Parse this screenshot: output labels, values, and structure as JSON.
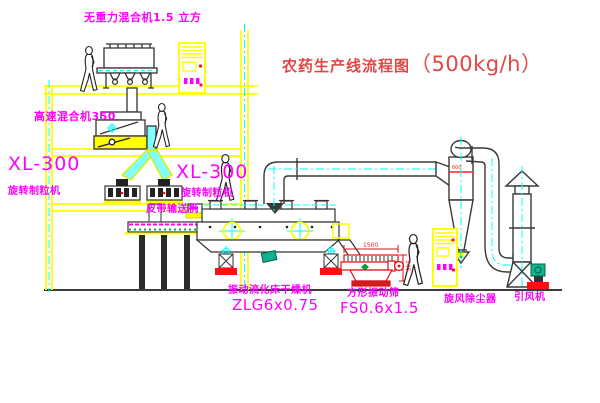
{
  "title": {
    "name": "农药生产线流程图",
    "capacity": "（500kg/h）"
  },
  "equipment_labels": {
    "gravity_mixer": "无重力混合机1.5 立方",
    "high_speed_mixer": "高速混合机350",
    "granulator_left": {
      "model": "XL-300",
      "name": "旋转制粒机"
    },
    "granulator_mid": {
      "model": "XL-300",
      "name": "旋转制粒机"
    },
    "belt_conveyor": "皮带输送机",
    "fluid_bed_dryer": {
      "name": "振动流化床干燥机",
      "model": "ZLG6x0.75"
    },
    "vibrating_screen": {
      "name": "方形振动筛",
      "model": "FS0.6x1.5"
    },
    "cyclone_dust_collector": "旋风除尘器",
    "induced_draft_fan": "引风机"
  },
  "dimensions": {
    "screen_length": "1500",
    "screen_height": "545",
    "cyclone_dia": "600"
  },
  "colors": {
    "background": "#ffffff",
    "structure_yellow": "#ffff00",
    "machine_line": "#3a3a3a",
    "centerline_cyan": "#00ffff",
    "label_magenta": "#ff00ff",
    "title_red": "#e04848",
    "accent_red": "#ff1010",
    "accent_green": "#00a040",
    "chute_fill": "#7fffff"
  }
}
